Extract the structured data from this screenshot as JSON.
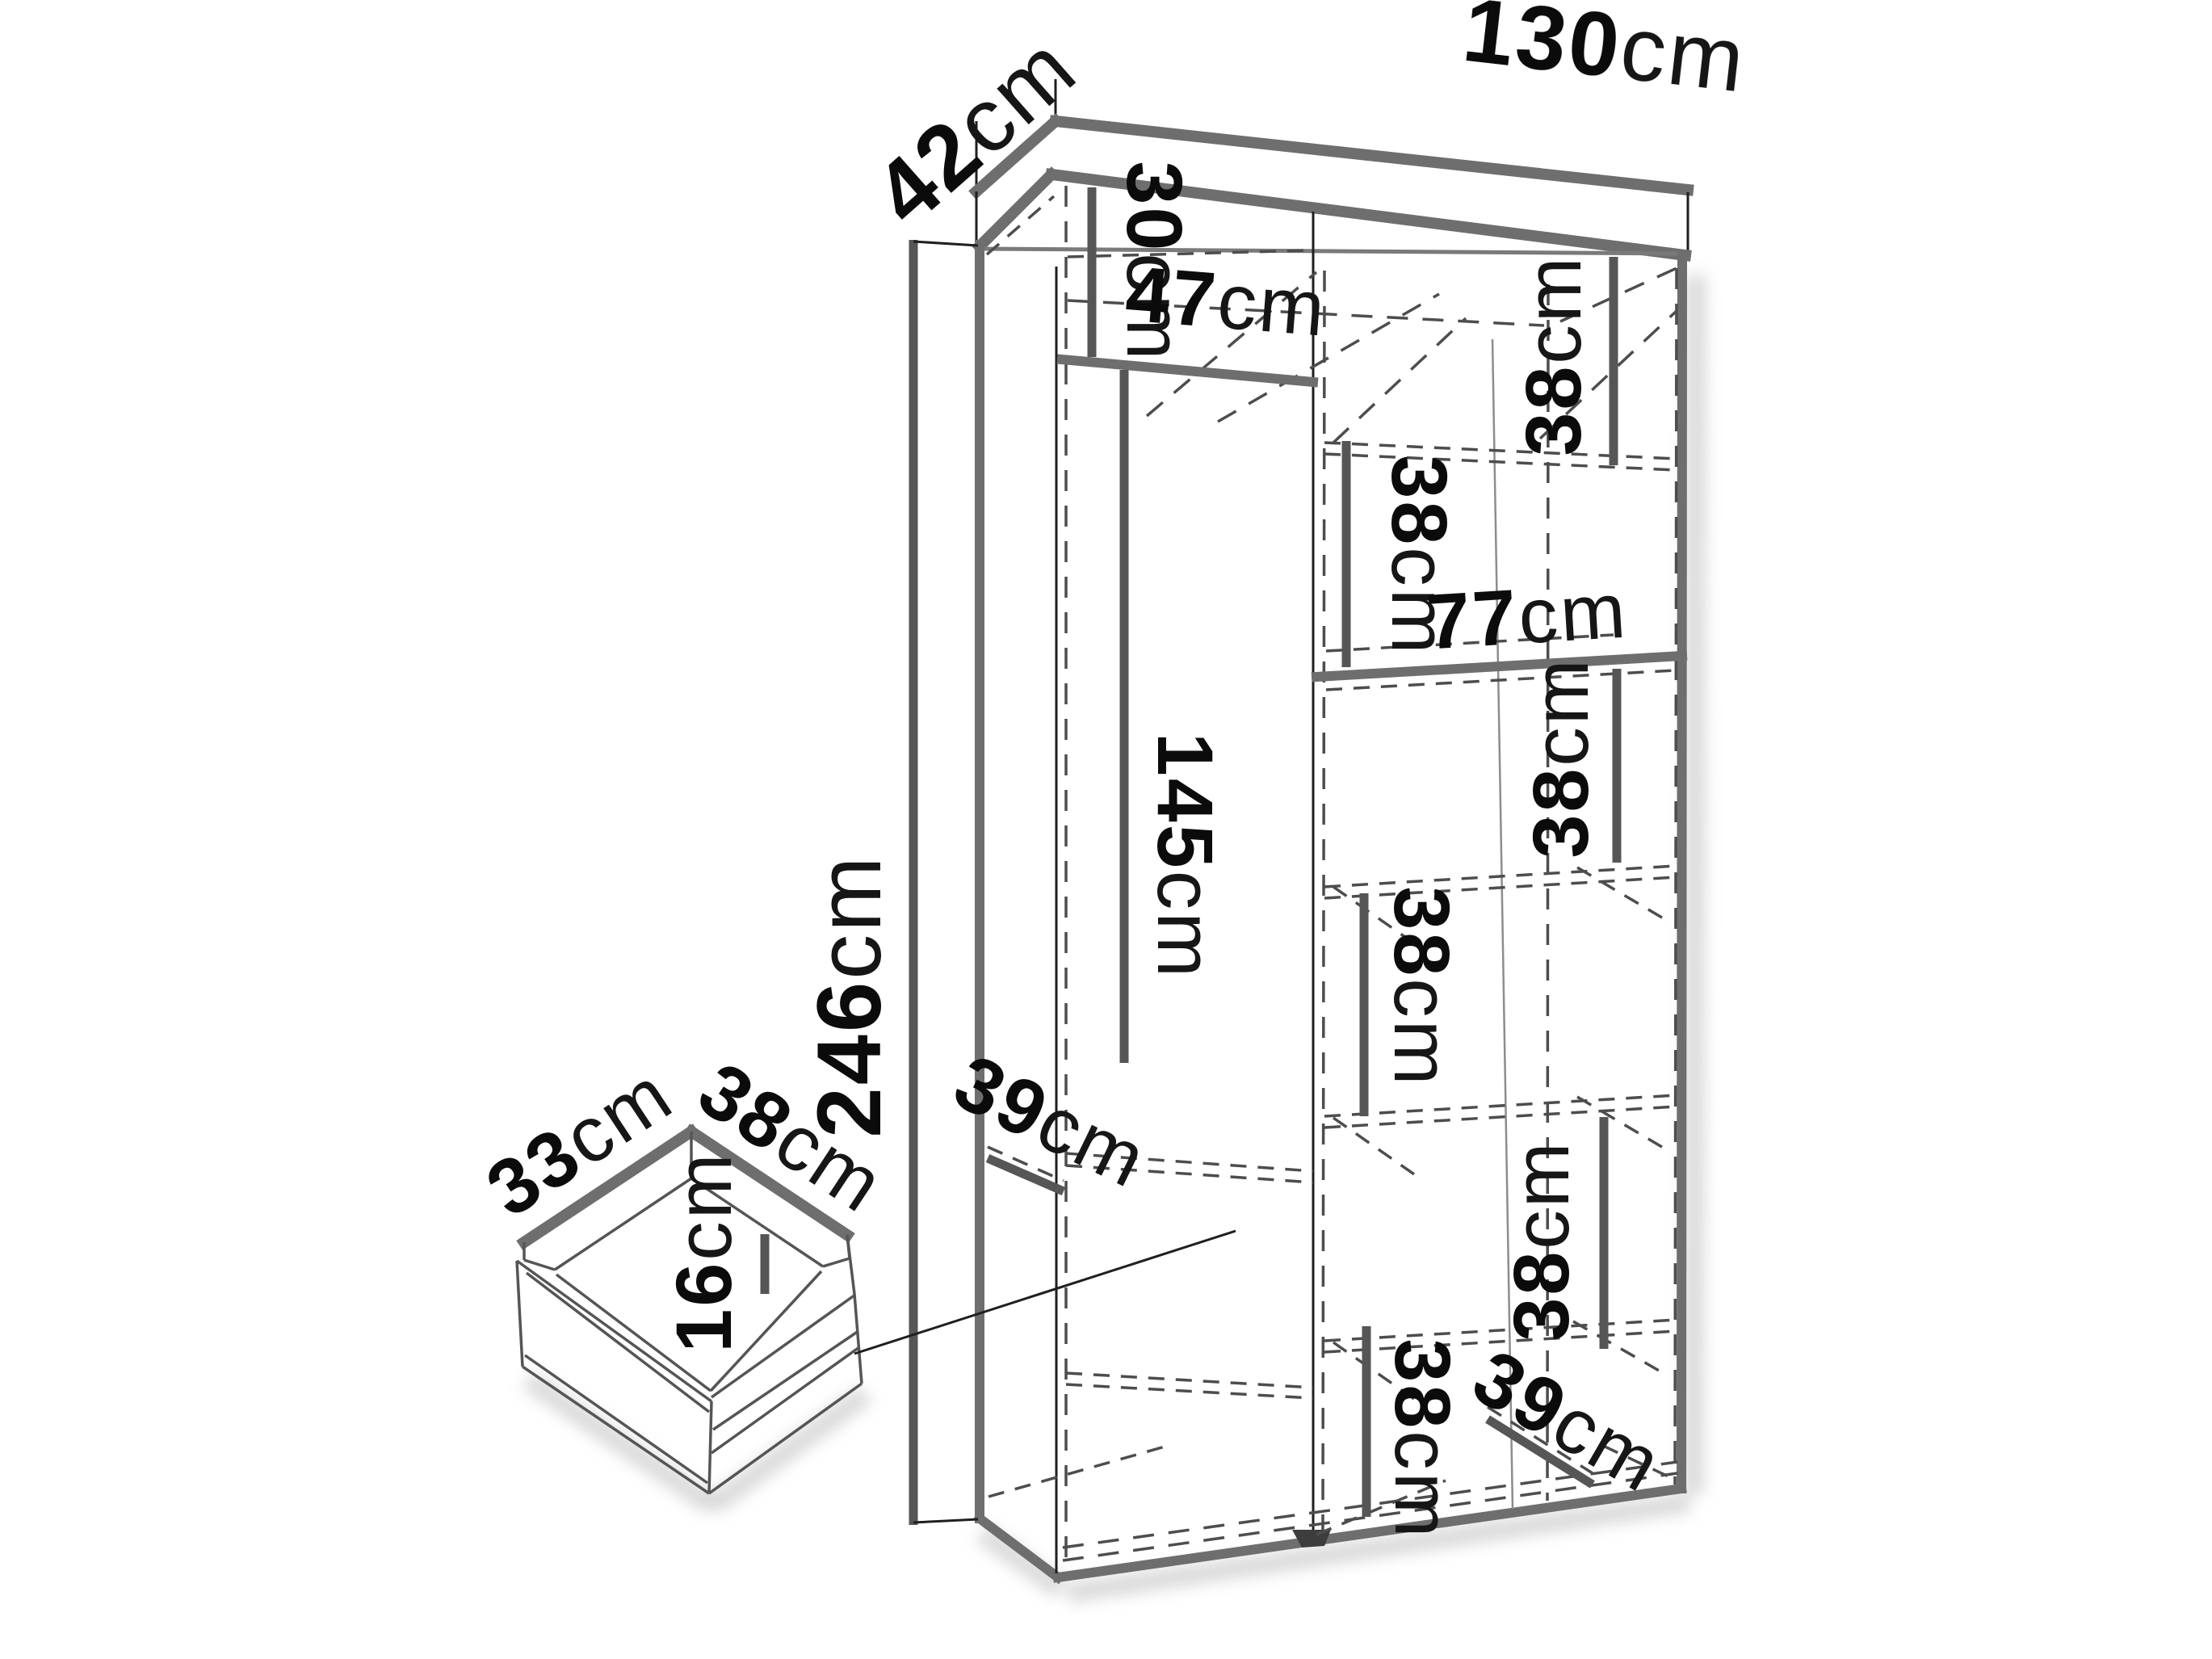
{
  "diagram": {
    "type": "furniture-dimension-diagram",
    "subject": "wardrobe with internal shelves and drawer detail",
    "units": "cm",
    "wardrobe": {
      "width_cm": 130,
      "depth_cm": 42,
      "height_cm": 246,
      "top_left_compartment_height_cm": 30,
      "left_compartment_width_cm": 47,
      "hanging_space_height_cm": 145,
      "right_section_width_cm": 77,
      "shelf_spacing_cm": [
        38,
        38,
        38,
        38,
        38,
        38
      ],
      "shelf_depth_left_cm": 39,
      "shelf_depth_right_cm": 39
    },
    "drawer": {
      "width_cm": 33,
      "depth_cm": 38,
      "height_cm": 16
    },
    "colors": {
      "background": "#ffffff",
      "structure_lines": "#6e6e6e",
      "measure_bars": "#565656",
      "hidden_lines_dashed": "#4d4d4d",
      "text": "#0b0b0b"
    }
  },
  "labels": {
    "w130": {
      "num": "130",
      "unit": "cm"
    },
    "d42": {
      "num": "42",
      "unit": "cm"
    },
    "h246": {
      "num": "246",
      "unit": "cm"
    },
    "t30": {
      "num": "30",
      "unit": "cm"
    },
    "t47": {
      "num": "47",
      "unit": "cm"
    },
    "s77": {
      "num": "77",
      "unit": "cm"
    },
    "h145": {
      "num": "145",
      "unit": "cm"
    },
    "r38a": {
      "num": "38",
      "unit": "cm"
    },
    "r38b": {
      "num": "38",
      "unit": "cm"
    },
    "r38c": {
      "num": "38",
      "unit": "cm"
    },
    "r38d": {
      "num": "38",
      "unit": "cm"
    },
    "r38e": {
      "num": "38",
      "unit": "cm"
    },
    "r38f": {
      "num": "38",
      "unit": "cm"
    },
    "l39": {
      "num": "39",
      "unit": "cm"
    },
    "r39": {
      "num": "39",
      "unit": "cm"
    },
    "dr33": {
      "num": "33",
      "unit": "cm"
    },
    "dr38": {
      "num": "38",
      "unit": "cm"
    },
    "dr16": {
      "num": "16",
      "unit": "cm"
    }
  }
}
